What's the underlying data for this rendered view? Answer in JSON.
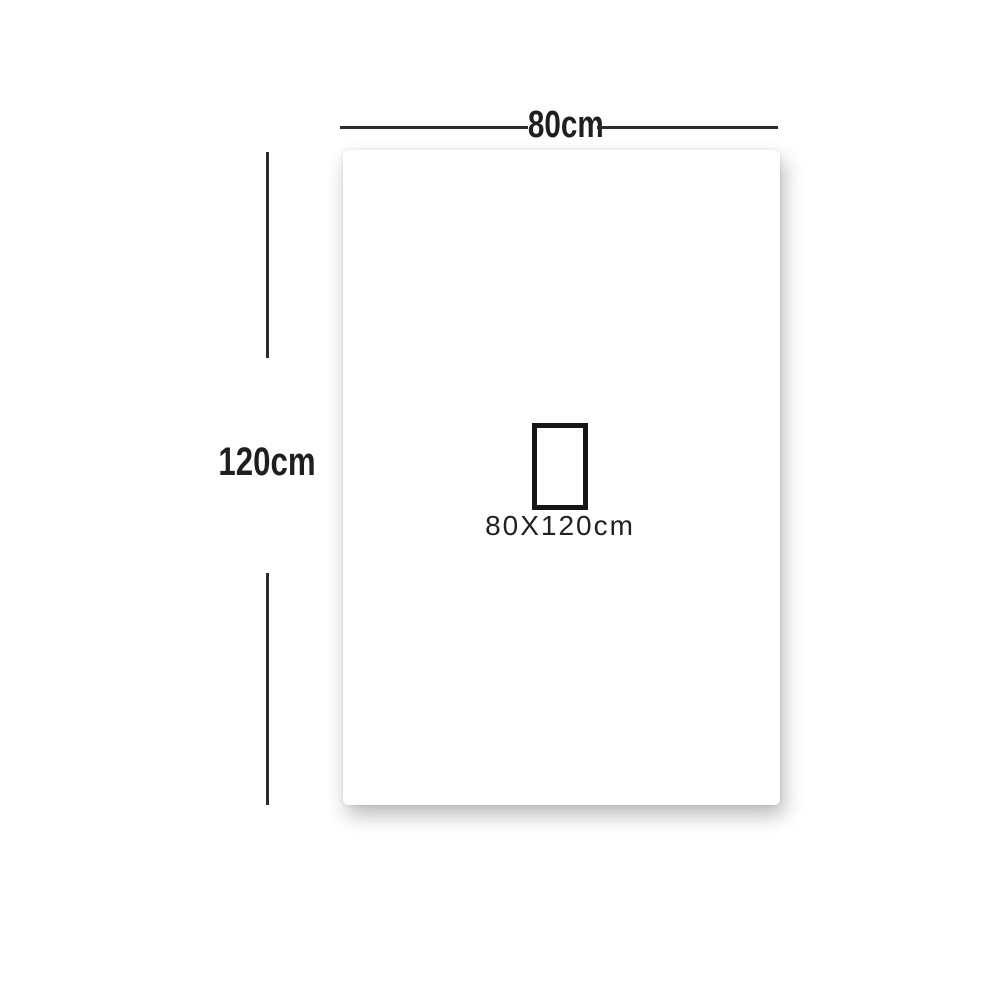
{
  "diagram": {
    "title": "product-size-diagram",
    "width_label": "80cm",
    "height_label": "120cm",
    "size_label": "80X120cm"
  },
  "colors": {
    "line": "#2b2b2b",
    "text": "#1f1f1f",
    "background": "#ffffff",
    "small_rect_border": "#161616"
  }
}
